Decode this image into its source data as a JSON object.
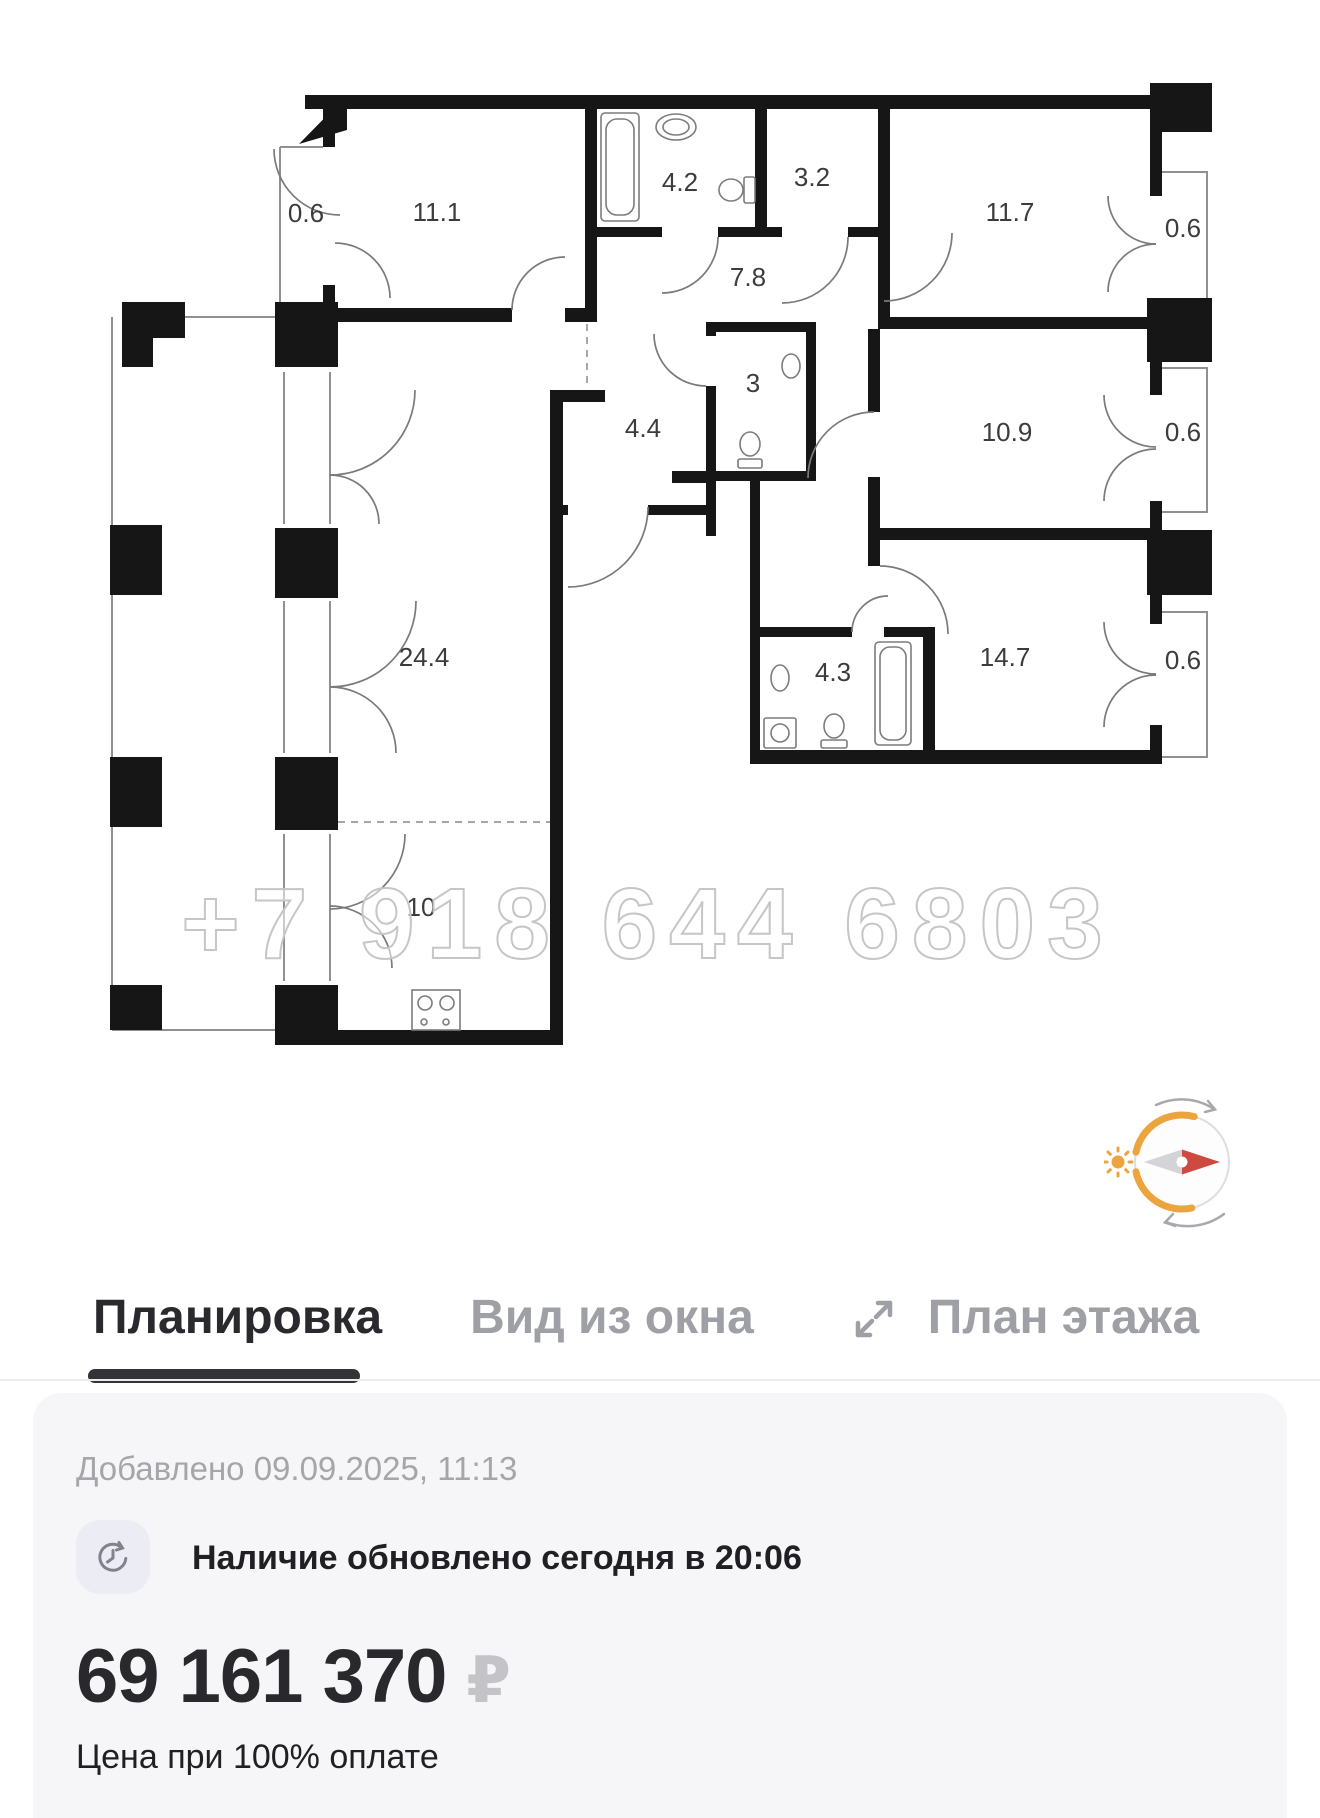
{
  "floor_plan": {
    "watermark": "+7 918 644 6803",
    "rooms": [
      {
        "name": "balcony-top-left",
        "area": "0.6"
      },
      {
        "name": "bedroom-1",
        "area": "11.1"
      },
      {
        "name": "bathroom-1",
        "area": "4.2"
      },
      {
        "name": "storage",
        "area": "3.2"
      },
      {
        "name": "bedroom-2",
        "area": "11.7"
      },
      {
        "name": "balcony-right-1",
        "area": "0.6"
      },
      {
        "name": "hallway",
        "area": "7.8"
      },
      {
        "name": "wc",
        "area": "3"
      },
      {
        "name": "hall-entry",
        "area": "4.4"
      },
      {
        "name": "bedroom-3",
        "area": "10.9"
      },
      {
        "name": "balcony-right-2",
        "area": "0.6"
      },
      {
        "name": "living-room",
        "area": "24.4"
      },
      {
        "name": "bathroom-2",
        "area": "4.3"
      },
      {
        "name": "bedroom-4",
        "area": "14.7"
      },
      {
        "name": "balcony-right-3",
        "area": "0.6"
      },
      {
        "name": "kitchen",
        "area": "10"
      }
    ]
  },
  "compass": {
    "accent_orange": "#ECA43E",
    "needle_red": "#CC4A3F",
    "needle_gray": "#d4d4d8"
  },
  "tabs": [
    {
      "label": "Планировка",
      "active": true
    },
    {
      "label": "Вид из окна",
      "active": false
    },
    {
      "label": "План этажа",
      "active": false
    }
  ],
  "info": {
    "added": "Добавлено 09.09.2025, 11:13",
    "availability": "Наличие обновлено сегодня в 20:06",
    "price": "69 161 370",
    "currency": "₽",
    "price_note": "Цена при 100% оплате"
  }
}
